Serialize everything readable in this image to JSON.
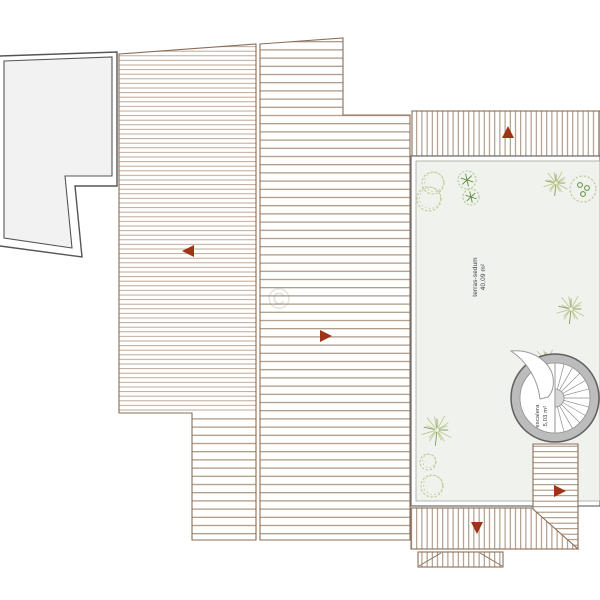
{
  "labels": {
    "terrace": {
      "name": "terras-sedum",
      "area": "40,09 m²"
    },
    "stair": {
      "name": "escalera",
      "area": "5,03 m²"
    }
  },
  "watermark": "©",
  "colors": {
    "hatch_light": "#b79e8b",
    "hatch_dark": "#a18974",
    "roof_edge": "#8b6e58",
    "plot_edge": "#555555",
    "terrace_fill": "#f0f2ee",
    "terrace_edge": "#6b6b6b",
    "arrow": "#9e3417",
    "stair_ring": "#bcbcbc",
    "plant_light": "#bcca92",
    "plant_dark": "#7fa055",
    "plant_accent": "#5d8c3c"
  },
  "drawing": {
    "arrows": [
      {
        "dir": "left",
        "x": 189,
        "y": 251
      },
      {
        "dir": "right",
        "x": 325,
        "y": 336
      },
      {
        "dir": "up",
        "x": 508,
        "y": 133
      },
      {
        "dir": "down",
        "x": 477,
        "y": 527
      },
      {
        "dir": "right",
        "x": 559,
        "y": 491
      }
    ],
    "plants": [
      {
        "type": "palm",
        "x": 556,
        "y": 183,
        "r": 13
      },
      {
        "type": "palm",
        "x": 571,
        "y": 309,
        "r": 15
      },
      {
        "type": "palm",
        "x": 546,
        "y": 362,
        "r": 14
      },
      {
        "type": "palm",
        "x": 437,
        "y": 430,
        "r": 16
      },
      {
        "type": "bush",
        "lobes": [
          [
            433,
            183,
            11
          ],
          [
            429,
            199,
            12
          ]
        ]
      },
      {
        "type": "bush",
        "lobes": [
          [
            428,
            462,
            8
          ],
          [
            432,
            486,
            11
          ]
        ]
      },
      {
        "type": "round",
        "x": 467,
        "y": 180,
        "r": 9
      },
      {
        "type": "round",
        "x": 471,
        "y": 197,
        "r": 8
      },
      {
        "type": "leafbush",
        "x": 583,
        "y": 189,
        "r": 13
      }
    ],
    "stair": {
      "cx": 555,
      "cy": 398,
      "rOuter": 44,
      "rInner": 35,
      "treadAngles": [
        -75,
        -60,
        -45,
        -30,
        -15,
        0,
        15,
        30,
        45,
        60,
        75,
        90
      ]
    }
  }
}
